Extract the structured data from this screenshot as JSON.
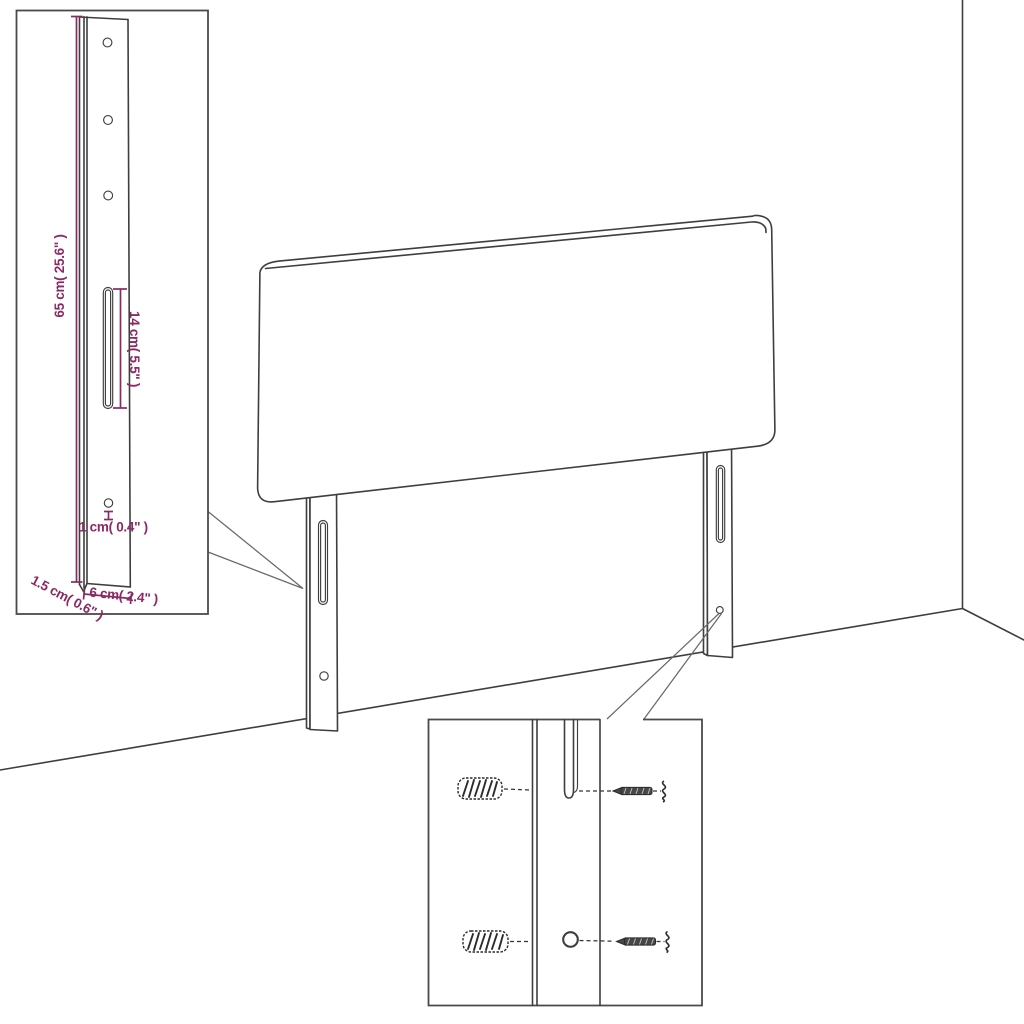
{
  "title": "headboard-assembly-dimension-diagram",
  "colors": {
    "background": "#ffffff",
    "line_art": "#3e3e3e",
    "inset_border": "#4a4a4a",
    "dimension_accent": "#8a2a64"
  },
  "bracket_detail": {
    "name": "bracket-detail-inset",
    "dim_height": "65 cm( 25.6\" )",
    "dim_slot": "14 cm( 5.5\" )",
    "dim_hole": "1 cm( 0.4\" )",
    "dim_thickness": "1.5 cm( 0.6\" )",
    "dim_width": "6 cm( 2.4\" )",
    "icons": [
      "mounting-hole-icon",
      "mounting-slot-icon"
    ]
  },
  "mounting_detail": {
    "name": "mounting-hardware-inset",
    "icons": [
      "wall-plug-icon",
      "screw-icon",
      "leg-slot-icon",
      "leg-hole-icon"
    ]
  }
}
